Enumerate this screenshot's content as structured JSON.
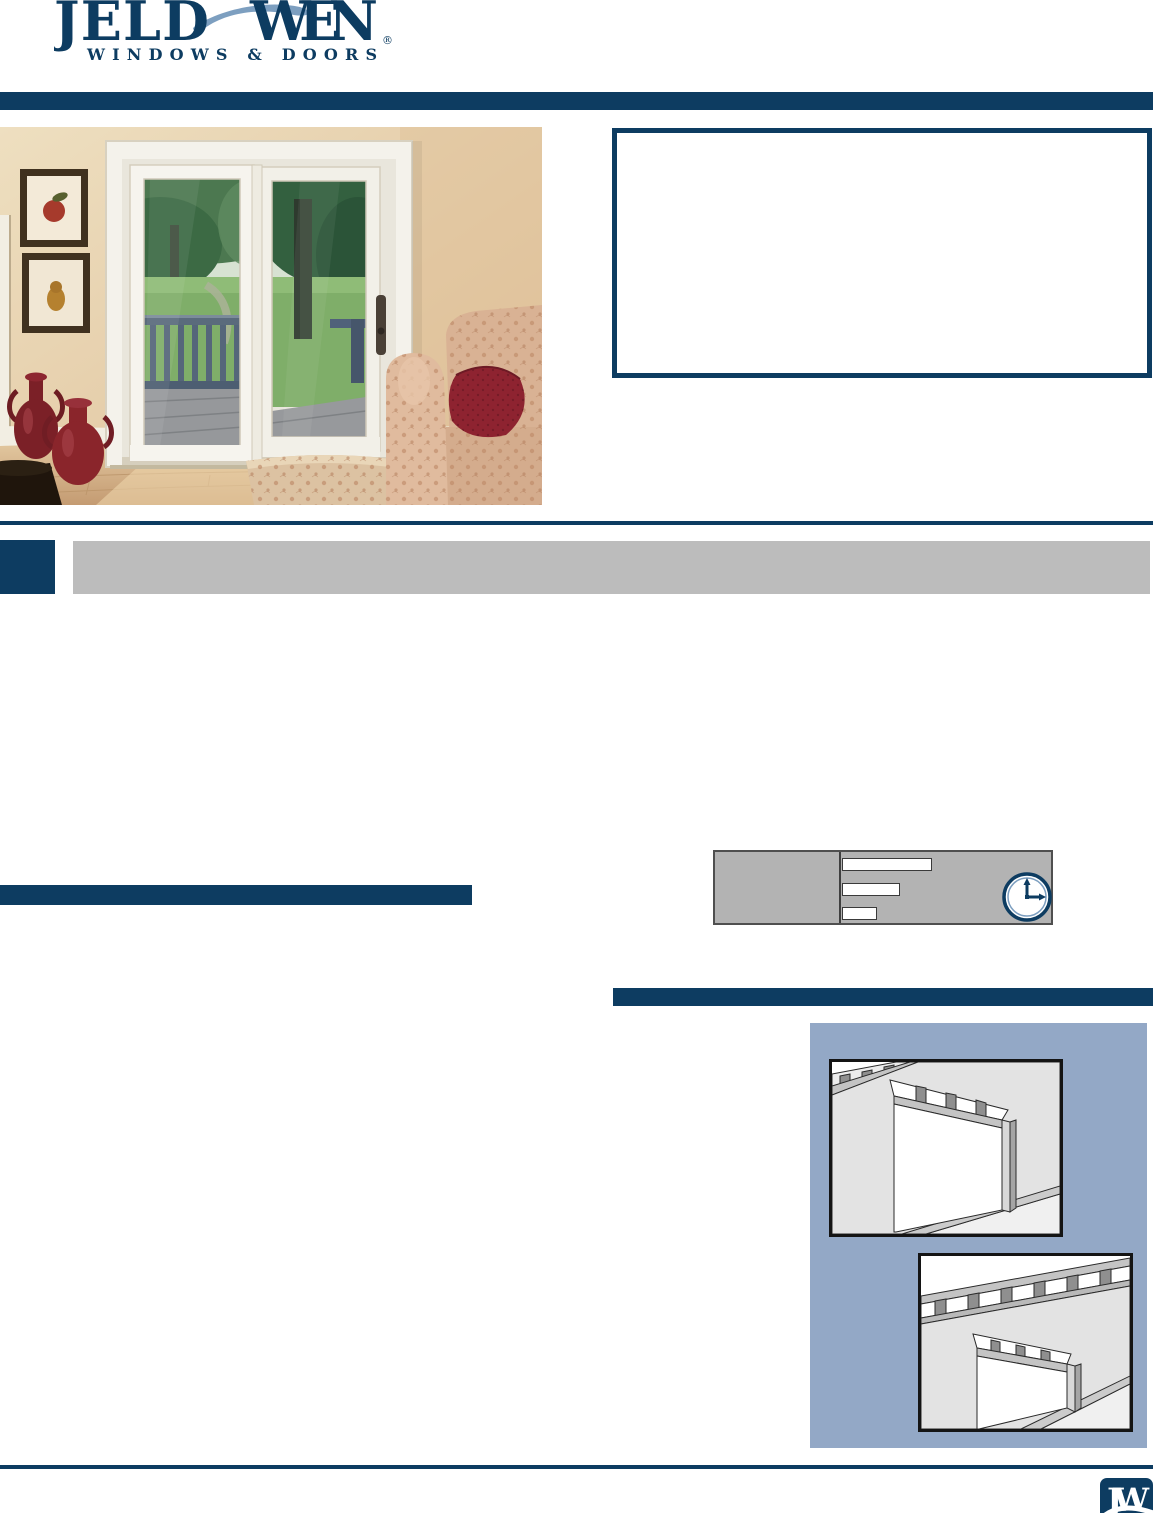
{
  "brand": {
    "name_left": "JELD",
    "name_right": "WEN",
    "registered_mark": "®",
    "tagline": "WINDOWS & DOORS"
  },
  "footer": {
    "monogram": "JW"
  },
  "icons": {
    "clock": "clock-icon",
    "brand_swoosh": "swoosh-icon"
  },
  "images": {
    "hero_photo": "patio-door-living-room-photo",
    "illustration_top": "wall-framing-rough-opening-illustration",
    "illustration_bottom": "wall-framing-door-opening-illustration"
  },
  "spec_panel": {
    "blank_fields": 3
  },
  "colors": {
    "navy": "#0d3c61",
    "swoosh_blue": "#7d9fc0",
    "section_bar_gray": "#bcbcbc",
    "spec_box_gray": "#b3b3b3",
    "panel_slate": "#93a8c6"
  }
}
